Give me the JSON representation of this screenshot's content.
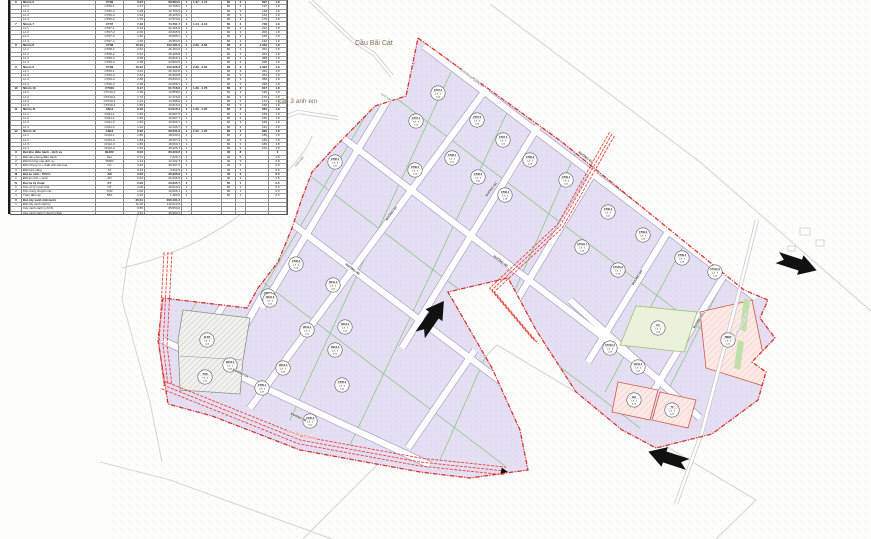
{
  "map": {
    "bridge1": {
      "text": "Cầu Bãi Cát"
    },
    "bridge2": {
      "text": "cầu 3 anh em"
    },
    "circle_ratio": "1,8 - 3",
    "colors": {
      "boundary_red": "#e03127",
      "plot_lavender": "#e5dff3",
      "plot_green": "#eaf2dc",
      "plot_pink": "#fbeae6",
      "road_edge": "#aaa0c8",
      "green_line": "#7cc47c",
      "corridor_red": "#e8443a"
    },
    "road_labels": [
      {
        "x": 470,
        "y": 78,
        "r": 37,
        "t": "ĐƯỜNG SỐ 2",
        "s": "gray"
      },
      {
        "x": 585,
        "y": 158,
        "r": 37,
        "t": "ĐƯỜNG Đ1",
        "s": "box"
      },
      {
        "x": 500,
        "y": 262,
        "r": 37,
        "t": "ĐƯỜNG N2",
        "s": "box"
      },
      {
        "x": 352,
        "y": 270,
        "r": 37,
        "t": "ĐƯỜNG N3",
        "s": "box"
      },
      {
        "x": 282,
        "y": 208,
        "r": -53,
        "t": "ĐƯỜNG D1",
        "s": "box"
      },
      {
        "x": 392,
        "y": 214,
        "r": -53,
        "t": "ĐƯỜNG D2",
        "s": "box"
      },
      {
        "x": 492,
        "y": 190,
        "r": -53,
        "t": "ĐƯỜNG D3",
        "s": "box"
      },
      {
        "x": 638,
        "y": 278,
        "r": -58,
        "t": "ĐƯỜNG D5",
        "s": "box"
      },
      {
        "x": 700,
        "y": 320,
        "r": -58,
        "t": "ĐƯỜNG D2-2",
        "s": "box"
      },
      {
        "x": 240,
        "y": 374,
        "r": 25,
        "t": "ĐƯỜNG D4",
        "s": "box"
      },
      {
        "x": 298,
        "y": 418,
        "r": 25,
        "t": "ĐƯỜNG N6",
        "s": "box"
      },
      {
        "x": 386,
        "y": 98,
        "r": 35,
        "t": "suối tràm",
        "s": "green"
      },
      {
        "x": 300,
        "y": 162,
        "r": -50,
        "t": "suối tràm",
        "s": "green"
      },
      {
        "x": 742,
        "y": 326,
        "r": -62,
        "t": "Đường Xóm Mới",
        "s": "gray"
      },
      {
        "x": 302,
        "y": 436,
        "r": 14,
        "t": "ĐD 110KV HIỆN HỮU",
        "s": "red"
      }
    ],
    "plots": [
      {
        "x": 335,
        "y": 162,
        "code": "CT06-1",
        "area": "1,37"
      },
      {
        "x": 415,
        "y": 170,
        "code": "CT06-2",
        "area": "1,28"
      },
      {
        "x": 296,
        "y": 264,
        "code": "CT06-3",
        "area": "1,64"
      },
      {
        "x": 268,
        "y": 296,
        "code": "CT06-4",
        "area": "1,75"
      },
      {
        "x": 416,
        "y": 121,
        "code": "CT07-1",
        "area": "2,12"
      },
      {
        "x": 438,
        "y": 93,
        "code": "CT07-2",
        "area": "2,06"
      },
      {
        "x": 477,
        "y": 120,
        "code": "CT07-3",
        "area": "1,66"
      },
      {
        "x": 503,
        "y": 140,
        "code": "CT07-4",
        "area": "1,66"
      },
      {
        "x": 452,
        "y": 158,
        "code": "CT08-1",
        "area": "2,62"
      },
      {
        "x": 478,
        "y": 177,
        "code": "CT08-2",
        "area": "2,64"
      },
      {
        "x": 530,
        "y": 160,
        "code": "CT08-3",
        "area": "2,58"
      },
      {
        "x": 505,
        "y": 195,
        "code": "CT08-4",
        "area": "2,38"
      },
      {
        "x": 566,
        "y": 180,
        "code": "CT09-1",
        "area": "2,62"
      },
      {
        "x": 608,
        "y": 212,
        "code": "CT09-2",
        "area": "2,64"
      },
      {
        "x": 643,
        "y": 235,
        "code": "CT09-3",
        "area": "2,58"
      },
      {
        "x": 682,
        "y": 258,
        "code": "CT09-4",
        "area": "2,38"
      },
      {
        "x": 582,
        "y": 247,
        "code": "CT010-1",
        "area": "1,39"
      },
      {
        "x": 618,
        "y": 270,
        "code": "CT010-2",
        "area": "1,76"
      },
      {
        "x": 715,
        "y": 272,
        "code": "CT010-3",
        "area": "1,44"
      },
      {
        "x": 610,
        "y": 348,
        "code": "CT010-4",
        "area": "1,58"
      },
      {
        "x": 638,
        "y": 367,
        "code": "CN11-1",
        "area": "1,69"
      },
      {
        "x": 333,
        "y": 285,
        "code": "CN11-2",
        "area": "1,60"
      },
      {
        "x": 270,
        "y": 300,
        "code": "CN11-3",
        "area": "1,65"
      },
      {
        "x": 307,
        "y": 330,
        "code": "CN11-4",
        "area": "1,22"
      },
      {
        "x": 345,
        "y": 327,
        "code": "CN12-1",
        "area": "1,80"
      },
      {
        "x": 230,
        "y": 365,
        "code": "CN12-2",
        "area": "1,83"
      },
      {
        "x": 283,
        "y": 368,
        "code": "CN12-3",
        "area": "1,80"
      },
      {
        "x": 335,
        "y": 350,
        "code": "CN12-4",
        "area": "1,52"
      },
      {
        "x": 262,
        "y": 388,
        "code": "CT05-1",
        "area": "1,37"
      },
      {
        "x": 310,
        "y": 421,
        "code": "CT05-2",
        "area": "1,52"
      },
      {
        "x": 342,
        "y": 385,
        "code": "CT05-3",
        "area": "1,44"
      },
      {
        "x": 207,
        "y": 340,
        "code": "XLNT",
        "area": "1,06"
      },
      {
        "x": 205,
        "y": 377,
        "code": "TCR",
        "area": "1,00"
      },
      {
        "x": 658,
        "y": 328,
        "code": "CX",
        "area": "1,05"
      },
      {
        "x": 728,
        "y": 340,
        "code": "TMDV",
        "area": "1,24"
      },
      {
        "x": 634,
        "y": 400,
        "code": "ĐH",
        "area": "0,72"
      },
      {
        "x": 672,
        "y": 410,
        "code": "TX",
        "area": "0,43"
      }
    ]
  },
  "table": {
    "rows": [
      {
        "b": 1,
        "c": [
          "6",
          "Nhóm 6",
          "CT06",
          "6.97",
          "69,684.0",
          "4",
          "1.37 - 1.74",
          "60",
          "3",
          "697",
          "1,8"
        ]
      },
      {
        "b": 0,
        "c": [
          "",
          "Lô 1",
          "CT06-1",
          "1.37",
          "13,705.0",
          "1",
          "",
          "60",
          "3",
          "137",
          "1,8"
        ]
      },
      {
        "b": 0,
        "c": [
          "",
          "Lô 2",
          "CT06-2",
          "1.28",
          "12,763.0",
          "1",
          "",
          "60",
          "3",
          "128",
          "1,8"
        ]
      },
      {
        "b": 0,
        "c": [
          "",
          "Lô 3",
          "CT06-3",
          "1.64",
          "16,425.0",
          "1",
          "",
          "60",
          "3",
          "164",
          "1,8"
        ]
      },
      {
        "b": 0,
        "c": [
          "",
          "Lô 4",
          "CT06-4",
          "1.75",
          "17,573.0",
          "1",
          "",
          "60",
          "3",
          "175",
          "1,8"
        ]
      },
      {
        "b": 1,
        "c": [
          "7",
          "Nhóm 7",
          "CT07",
          "7.48",
          "74,791.7",
          "4",
          "1.44 - 2.12",
          "60",
          "3",
          "748",
          "1,8"
        ]
      },
      {
        "b": 0,
        "c": [
          "",
          "Lô 1",
          "CT07-1",
          "2.12",
          "21,206.0",
          "1",
          "",
          "60",
          "3",
          "212",
          "1,8"
        ]
      },
      {
        "b": 0,
        "c": [
          "",
          "Lô 2",
          "CT07-2",
          "2.06",
          "20,645.5",
          "1",
          "",
          "60",
          "3",
          "206",
          "1,8"
        ]
      },
      {
        "b": 0,
        "c": [
          "",
          "Lô 3",
          "CT07-3",
          "1.66",
          "16,595.2",
          "1",
          "",
          "60",
          "3",
          "166",
          "1,8"
        ]
      },
      {
        "b": 0,
        "c": [
          "",
          "Lô 4",
          "CT07-4",
          "1.66",
          "16,554.5",
          "1",
          "",
          "60",
          "3",
          "166",
          "1,8"
        ]
      },
      {
        "b": 1,
        "c": [
          "8",
          "Nhóm 8",
          "CT08",
          "10.22",
          "102,181.0",
          "4",
          "2.36 - 2.64",
          "60",
          "3",
          "1,022",
          "1,8"
        ]
      },
      {
        "b": 0,
        "c": [
          "",
          "Lô 1",
          "CT08-1",
          "2.62",
          "26,154.6",
          "1",
          "",
          "60",
          "3",
          "262",
          "1,8"
        ]
      },
      {
        "b": 0,
        "c": [
          "",
          "Lô 2",
          "CT08-2",
          "2.64",
          "26,406.8",
          "1",
          "",
          "60",
          "3",
          "264",
          "1,8"
        ]
      },
      {
        "b": 0,
        "c": [
          "",
          "Lô 3",
          "CT08-3",
          "2.58",
          "25,816.1",
          "1",
          "",
          "60",
          "3",
          "258",
          "1,8"
        ]
      },
      {
        "b": 0,
        "c": [
          "",
          "Lô 4",
          "CT08-4",
          "2.38",
          "23,803.5",
          "1",
          "",
          "60",
          "3",
          "238",
          "1,8"
        ]
      },
      {
        "b": 1,
        "c": [
          "9",
          "Nhóm 9",
          "CT09",
          "10.22",
          "102,066.3",
          "4",
          "2.36 - 2.64",
          "60",
          "3",
          "1,022",
          "1,8"
        ]
      },
      {
        "b": 0,
        "c": [
          "",
          "Lô 1",
          "CT09-1",
          "2.62",
          "26,193.8",
          "1",
          "",
          "60",
          "3",
          "262",
          "1,8"
        ]
      },
      {
        "b": 0,
        "c": [
          "",
          "Lô 2",
          "CT09-2",
          "2.64",
          "26,369.8",
          "1",
          "",
          "60",
          "3",
          "264",
          "1,8"
        ]
      },
      {
        "b": 0,
        "c": [
          "",
          "Lô 3",
          "CT09-3",
          "2.58",
          "25,844.0",
          "1",
          "",
          "60",
          "3",
          "258",
          "1,8"
        ]
      },
      {
        "b": 0,
        "c": [
          "",
          "Lô 4",
          "CT09-4",
          "2.38",
          "23,658.7",
          "1",
          "",
          "60",
          "3",
          "238",
          "1,8"
        ]
      },
      {
        "b": 1,
        "c": [
          "10",
          "Nhóm 10",
          "CT010",
          "6.17",
          "61,716.0",
          "4",
          "1.39 - 1.76",
          "60",
          "3",
          "617",
          "1,8"
        ]
      },
      {
        "b": 0,
        "c": [
          "",
          "Lô 1",
          "CT010-1",
          "1.39",
          "13,858.6",
          "1",
          "",
          "60",
          "3",
          "139",
          "1,8"
        ]
      },
      {
        "b": 0,
        "c": [
          "",
          "Lô 2",
          "CT010-2",
          "1.76",
          "17,476.0",
          "1",
          "",
          "60",
          "3",
          "176",
          "1,8"
        ]
      },
      {
        "b": 0,
        "c": [
          "",
          "Lô 3",
          "CT010-3",
          "1.44",
          "14,388.0",
          "1",
          "",
          "60",
          "3",
          "144",
          "1,8"
        ]
      },
      {
        "b": 0,
        "c": [
          "",
          "Lô 4",
          "CT010-4",
          "1.58",
          "15,816.0",
          "1",
          "",
          "60",
          "3",
          "158",
          "1,8"
        ]
      },
      {
        "b": 1,
        "c": [
          "11",
          "Nhóm 11",
          "CN11",
          "6.45",
          "64,515.4",
          "4",
          "1.22 - 1.97",
          "60",
          "3",
          "645",
          "1,8"
        ]
      },
      {
        "b": 0,
        "c": [
          "",
          "Lô 1",
          "CN11-1",
          "1.69",
          "16,907.5",
          "1",
          "",
          "60",
          "3",
          "169",
          "1,8"
        ]
      },
      {
        "b": 0,
        "c": [
          "",
          "Lô 2",
          "CN11-2",
          "1.60",
          "16,007.7",
          "1",
          "",
          "60",
          "3",
          "160",
          "1,8"
        ]
      },
      {
        "b": 0,
        "c": [
          "",
          "Lô 3",
          "CN11-3",
          "1.65",
          "16,500.7",
          "1",
          "",
          "60",
          "3",
          "165",
          "1,8"
        ]
      },
      {
        "b": 0,
        "c": [
          "",
          "Lô 4",
          "CN11-4",
          "1.22",
          "12,246.7",
          "1",
          "",
          "60",
          "3",
          "122",
          "1,8"
        ]
      },
      {
        "b": 1,
        "c": [
          "12",
          "Nhóm 12",
          "CN12",
          "6.95",
          "69,531.8",
          "4",
          "1.22 - 1.97",
          "60",
          "3",
          "695",
          "1,8"
        ]
      },
      {
        "b": 0,
        "c": [
          "",
          "Lô 1",
          "CN12-1",
          "1.80",
          "18,040.2",
          "1",
          "",
          "60",
          "3",
          "180",
          "1,8"
        ]
      },
      {
        "b": 0,
        "c": [
          "",
          "Lô 2",
          "CN12-2",
          "1.83",
          "18,307.4",
          "1",
          "",
          "60",
          "3",
          "183",
          "1,8"
        ]
      },
      {
        "b": 0,
        "c": [
          "",
          "Lô 3",
          "CN12-3",
          "1.80",
          "18,060.7",
          "1",
          "",
          "60",
          "3",
          "180",
          "1,8"
        ]
      },
      {
        "b": 0,
        "c": [
          "",
          "Lô 4",
          "CN12-4",
          "1.52",
          "15,226.7",
          "1",
          "",
          "60",
          "3",
          "152",
          "1,8"
        ]
      },
      {
        "b": 1,
        "c": [
          "II",
          "Đất khu điều hành - dịch vụ",
          "ĐHDV",
          "8.03",
          "80,309.2",
          "4",
          "",
          "40",
          "8",
          "",
          "3"
        ]
      },
      {
        "b": 0,
        "c": [
          "1",
          "Đất văn phòng điều hành",
          "ĐH",
          "0.72",
          "7,226.7",
          "1",
          "",
          "40",
          "5",
          "",
          "1.5"
        ]
      },
      {
        "b": 0,
        "c": [
          "2",
          "Đất thương mại dịch vụ",
          "TMDV",
          "1.24",
          "12,432.7",
          "1",
          "",
          "40",
          "5",
          "",
          "0.8"
        ]
      },
      {
        "b": 0,
        "c": [
          "3",
          "Đất chung cư + thiết chế văn hoá",
          "CC",
          "3.92",
          "39,457.2",
          "1",
          "",
          "40",
          "5",
          "",
          "0.8"
        ]
      },
      {
        "b": 0,
        "c": [
          "4",
          "Đất trạm xăng",
          "TX",
          "0.43",
          "4,312.6",
          "1",
          "",
          "40",
          "1",
          "",
          "0.6"
        ]
      },
      {
        "b": 1,
        "c": [
          "III",
          "Đất an ninh - PCCC",
          "AN",
          "2.02",
          "20,236.6",
          "1",
          "",
          "40",
          "3",
          "",
          "0.5"
        ]
      },
      {
        "b": 0,
        "c": [
          "1",
          "Đất an ninh + pccc",
          "AN",
          "2.02",
          "20,236.6",
          "1",
          "",
          "40",
          "3",
          "",
          "1.5"
        ]
      },
      {
        "b": 1,
        "c": [
          "IV",
          "Đất hạ kỹ thuật",
          "KT",
          "2.06",
          "20,635.7",
          "4",
          "",
          "50",
          "1",
          "",
          "0.5"
        ]
      },
      {
        "b": 0,
        "c": [
          "1",
          "Khu xử lý nước thải",
          "NT",
          "1.06",
          "10,610.6",
          "1",
          "",
          "50",
          "1",
          "",
          "0.5"
        ]
      },
      {
        "b": 0,
        "c": [
          "2",
          "Khu trung chuyển rác",
          "TCR",
          "1.00",
          "10,006.1",
          "1",
          "",
          "50",
          "1",
          "",
          "0.5"
        ]
      },
      {
        "b": 0,
        "c": [
          "3",
          "Trạm điện áp",
          "TBA",
          "0.15",
          "1,480.0",
          "2",
          "",
          "50",
          "1",
          "",
          "0.5"
        ]
      },
      {
        "b": 1,
        "c": [
          "V",
          "Đất cây xanh mặt nước",
          "",
          "20.01",
          "200,131.2",
          "",
          "",
          "",
          "",
          "",
          ""
        ]
      },
      {
        "b": 0,
        "c": [
          "1",
          "Đất cây xanh cách ly",
          "",
          "11.06",
          "110,613.0",
          "",
          "",
          "",
          "",
          "",
          ""
        ]
      },
      {
        "b": 0,
        "c": [
          "",
          "Cây xanh cách ly KCN",
          "",
          "6.55",
          "65,550.0",
          "",
          "",
          "",
          "",
          "",
          ""
        ]
      },
      {
        "b": 0,
        "c": [
          "",
          "Cây xanh cách ly đường điện",
          "",
          "4.51",
          "45,063.0",
          "",
          "",
          "",
          "",
          "",
          ""
        ]
      },
      {
        "b": 0,
        "c": [
          "2",
          "Đất cây xanh cảnh quan",
          "",
          "3.07",
          "30,476.3",
          "",
          "",
          "",
          "",
          "",
          ""
        ]
      },
      {
        "b": 0,
        "c": [
          "3",
          "Đất mặt nước (kênh mương)",
          "",
          "4.52",
          "45,183.4",
          "",
          "",
          "",
          "",
          "",
          ""
        ]
      },
      {
        "b": 1,
        "c": [
          "VI",
          "Đất giao thông",
          "",
          "28.05",
          "280,514.2",
          "",
          "",
          "",
          "",
          "",
          ""
        ]
      },
      {
        "b": 0,
        "c": [
          "1",
          "Đường giao thông",
          "",
          "19.18",
          "191,821.0",
          "",
          "",
          "",
          "",
          "",
          ""
        ]
      },
      {
        "b": 0,
        "c": [
          "2",
          "Vỉa hè",
          "",
          "8.87",
          "88,693.2",
          "",
          "",
          "",
          "",
          "",
          ""
        ]
      },
      {
        "b": 1,
        "c": [
          "",
          "Tổng cộng",
          "",
          "136.98",
          "1,232,948.2",
          "",
          "",
          "",
          "",
          "",
          ""
        ]
      }
    ]
  }
}
